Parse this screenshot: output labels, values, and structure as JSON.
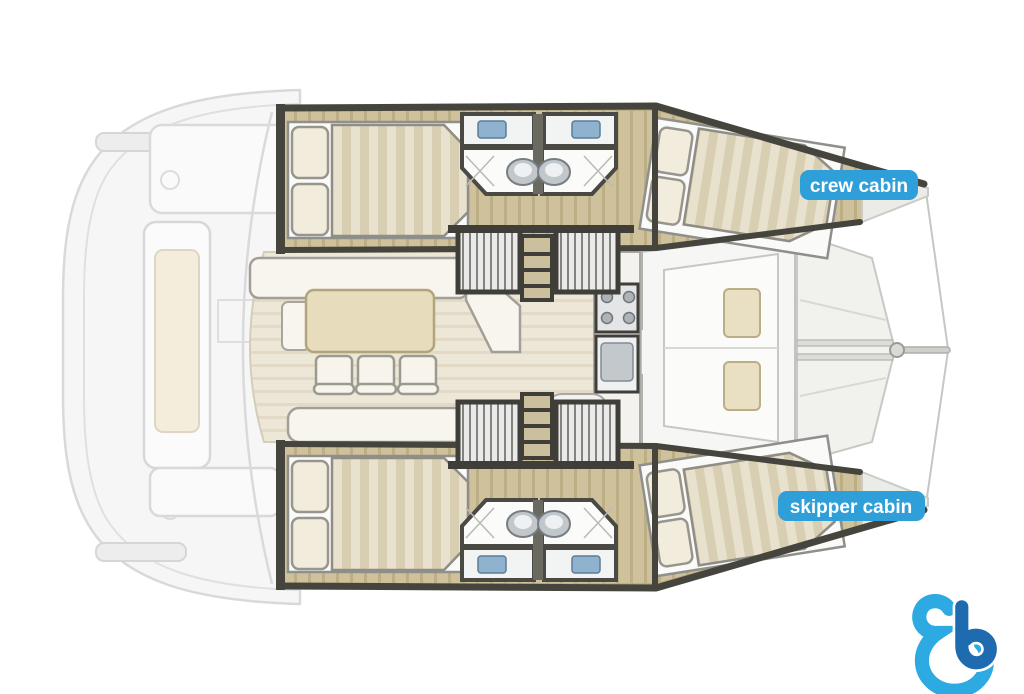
{
  "diagram": {
    "type": "catamaran-floor-plan",
    "badges": {
      "crew_cabin": "crew cabin",
      "skipper_cabin": "skipper cabin"
    },
    "colors": {
      "badge_blue": "#2e9fd9",
      "badge_text": "#ffffff",
      "logo_light_blue": "#2caae1",
      "logo_dark_blue": "#1e6bb0",
      "wood_floor": "#cfc19b",
      "bulkhead_dark": "#45443d",
      "cushion_beige": "#e9dfc2",
      "mattress_light": "#e8e1ce",
      "mattress_dark": "#d8ceb2",
      "faded_deck": "#f5f5f5",
      "background": "#ffffff"
    },
    "regions": [
      "stern-cockpit",
      "aft-cabin-port",
      "bathroom-port",
      "companionway-stairs-port",
      "saloon-dining",
      "galley",
      "forward-cockpit",
      "bow-trampoline",
      "bowsprit",
      "aft-cabin-starboard",
      "bathroom-starboard",
      "companionway-stairs-starboard",
      "crew-cabin",
      "skipper-cabin"
    ]
  },
  "logo": {
    "name": "b-watermark-logo"
  }
}
